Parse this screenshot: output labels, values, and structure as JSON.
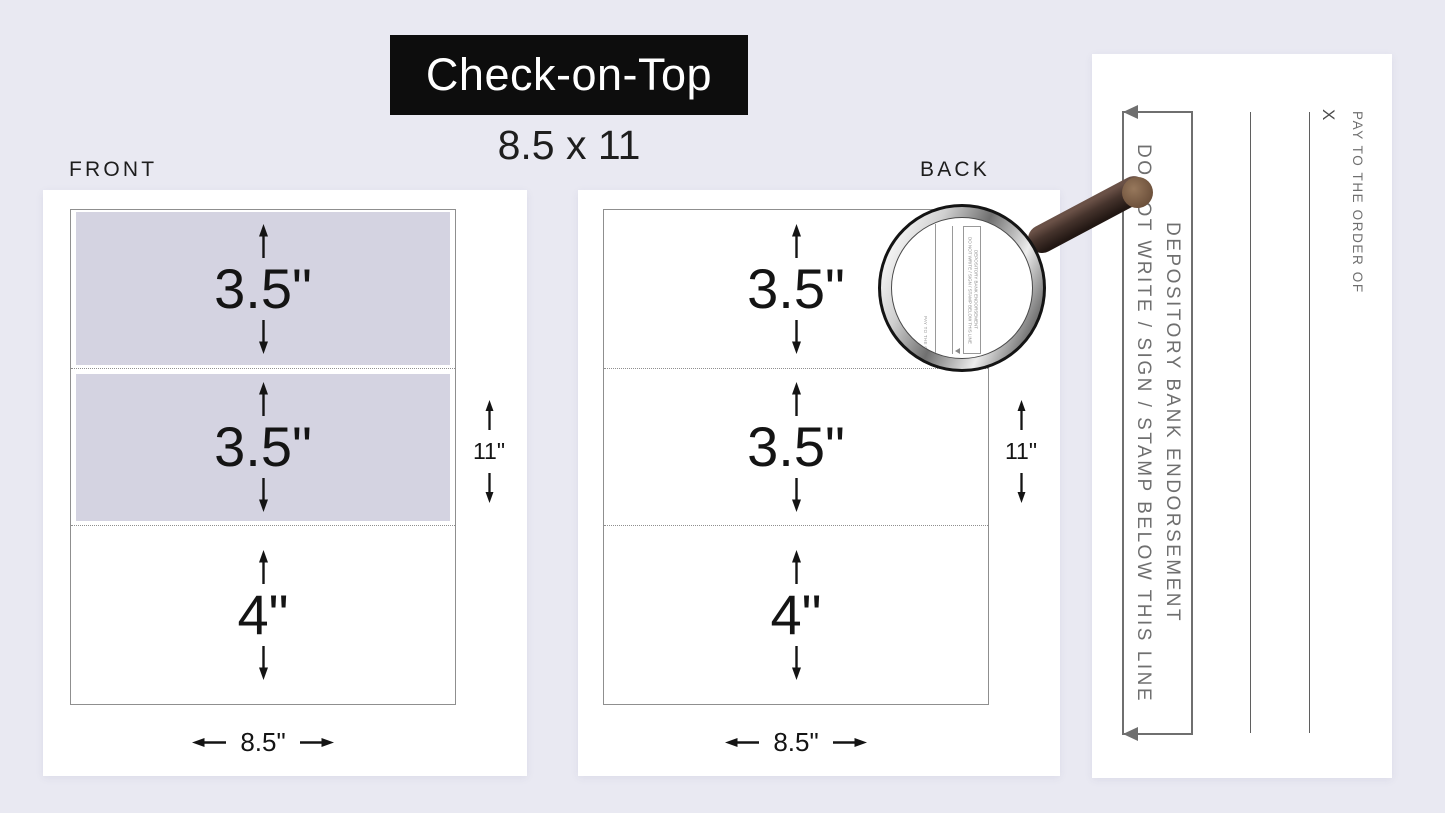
{
  "title": {
    "name": "Check-on-Top",
    "dimensions": "8.5 x 11"
  },
  "front": {
    "label": "FRONT",
    "sections": [
      {
        "height": "3.5\"",
        "shaded": true
      },
      {
        "height": "3.5\"",
        "shaded": true
      },
      {
        "height": "4\"",
        "shaded": false
      }
    ],
    "sheet_width": "8.5\"",
    "sheet_height": "11\""
  },
  "back": {
    "label": "BACK",
    "sections": [
      {
        "height": "3.5\"",
        "shaded": false
      },
      {
        "height": "3.5\"",
        "shaded": false
      },
      {
        "height": "4\"",
        "shaded": false
      }
    ],
    "sheet_width": "8.5\"",
    "sheet_height": "11\""
  },
  "magnifier": {
    "pay_label": "PAY TO THE ORDER OF",
    "box_line1": "DO NOT WRITE / SIGN / STAMP BELOW THIS LINE",
    "box_line2": "DEPOSITORY BANK ENDORSEMENT"
  },
  "endorsement_zoom": {
    "box_line1": "DO NOT WRITE / SIGN / STAMP BELOW THIS LINE",
    "box_line2": "DEPOSITORY BANK ENDORSEMENT",
    "sign_here": "X",
    "pay_label": "PAY TO THE ORDER OF"
  },
  "colors": {
    "background": "#e9e9f2",
    "banner": "#0d0d0d",
    "section_shade": "#d4d3e1",
    "endorsement_gray": "#6f6f6f"
  }
}
